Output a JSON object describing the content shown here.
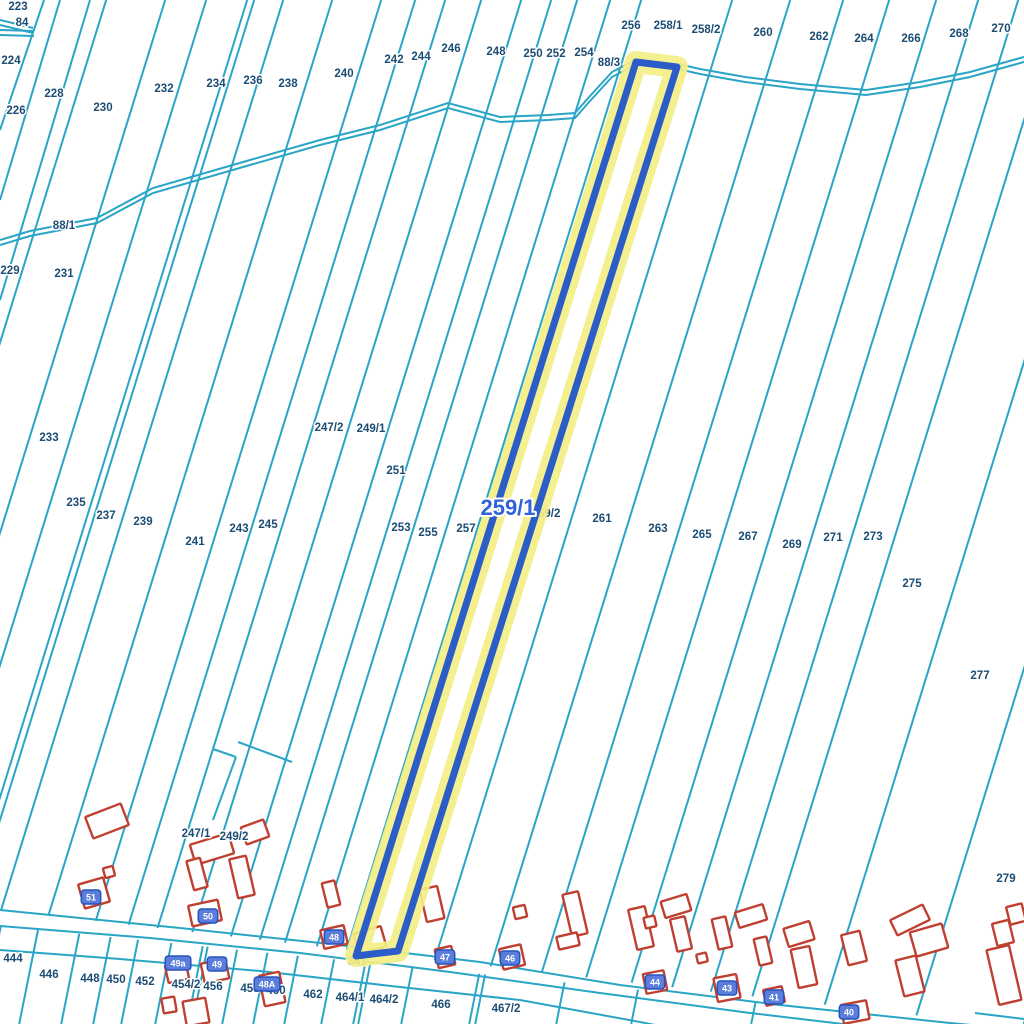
{
  "map": {
    "colors": {
      "line": "#2aa5c6",
      "stream": "#2aa5c6",
      "building": "#bf3f30",
      "label": "#1c4d74",
      "highlight_halo": "#f3ee86",
      "highlight_border": "#2b5cc8",
      "big_label_color": "#2f62d8",
      "plate_fill": "#5b7ddb",
      "plate_border": "#2753bd"
    },
    "highlight_parcel": {
      "label": "259/1",
      "points": [
        [
          636,
          62
        ],
        [
          677,
          67
        ],
        [
          398,
          951
        ],
        [
          356,
          956
        ]
      ]
    },
    "big_label": {
      "text": "259/1",
      "x": 508,
      "y": 507
    },
    "strip_lines": {
      "slope": 0.31,
      "y_ref": 520,
      "xm": [
        -55,
        4,
        45,
        86,
        93,
        122,
        171,
        220,
        254,
        284,
        320,
        360,
        390,
        416,
        449,
        480,
        571,
        629,
        682,
        728,
        775,
        817,
        857,
        900,
        975,
        1070,
        1180,
        1290
      ]
    },
    "lower_lot_lines": {
      "slope": 0.2,
      "y_ref": 980,
      "xb": [
        -10,
        28,
        70,
        102,
        130,
        164,
        196,
        201,
        231,
        262,
        293,
        330,
        362,
        367,
        410,
        478,
        484,
        565,
        640,
        760
      ]
    },
    "road_lines": [
      [
        [
          0,
          910
        ],
        [
          180,
          928
        ],
        [
          330,
          944
        ],
        [
          480,
          962
        ],
        [
          620,
          985
        ],
        [
          780,
          1005
        ],
        [
          950,
          1023
        ],
        [
          1024,
          1030
        ]
      ],
      [
        [
          0,
          926
        ],
        [
          150,
          938
        ],
        [
          300,
          953
        ],
        [
          450,
          972
        ],
        [
          600,
          993
        ],
        [
          750,
          1013
        ],
        [
          860,
          1026
        ]
      ],
      [
        [
          0,
          950
        ],
        [
          120,
          959
        ],
        [
          260,
          971
        ],
        [
          400,
          987
        ],
        [
          520,
          1000
        ],
        [
          640,
          1022
        ],
        [
          660,
          1026
        ]
      ]
    ],
    "extra_segments": [
      [
        [
          44,
          0
        ],
        [
          0,
          130
        ]
      ],
      [
        [
          60,
          0
        ],
        [
          0,
          200
        ]
      ],
      [
        [
          90,
          0
        ],
        [
          0,
          300
        ]
      ],
      [
        [
          213,
          749
        ],
        [
          236,
          757
        ]
      ],
      [
        [
          238,
          742
        ],
        [
          292,
          762
        ]
      ],
      [
        [
          236,
          757
        ],
        [
          213,
          820
        ]
      ],
      [
        [
          975,
          1013
        ],
        [
          1024,
          1019
        ]
      ]
    ],
    "stream_paths": [
      [
        [
          0,
          240
        ],
        [
          30,
          231
        ],
        [
          97,
          218
        ],
        [
          153,
          188
        ],
        [
          250,
          160
        ],
        [
          320,
          140
        ],
        [
          380,
          125
        ],
        [
          448,
          103
        ],
        [
          500,
          117
        ],
        [
          548,
          115
        ],
        [
          575,
          113
        ],
        [
          590,
          96
        ],
        [
          612,
          72
        ],
        [
          633,
          61
        ]
      ],
      [
        [
          678,
          64
        ],
        [
          700,
          69
        ],
        [
          745,
          77
        ],
        [
          800,
          84
        ],
        [
          866,
          90
        ],
        [
          920,
          82
        ],
        [
          970,
          72
        ],
        [
          1024,
          57
        ]
      ],
      [
        [
          0,
          20
        ],
        [
          33,
          28
        ]
      ],
      [
        [
          0,
          30
        ],
        [
          34,
          31
        ]
      ]
    ],
    "stream_gap": 5,
    "parcel_labels": [
      {
        "text": "223",
        "x": 18,
        "y": 6
      },
      {
        "text": "84",
        "x": 22,
        "y": 22
      },
      {
        "text": "224",
        "x": 11,
        "y": 60
      },
      {
        "text": "226",
        "x": 16,
        "y": 110
      },
      {
        "text": "228",
        "x": 54,
        "y": 93
      },
      {
        "text": "230",
        "x": 103,
        "y": 107
      },
      {
        "text": "232",
        "x": 164,
        "y": 88
      },
      {
        "text": "234",
        "x": 216,
        "y": 83
      },
      {
        "text": "236",
        "x": 253,
        "y": 80
      },
      {
        "text": "238",
        "x": 288,
        "y": 83
      },
      {
        "text": "240",
        "x": 344,
        "y": 73
      },
      {
        "text": "242",
        "x": 394,
        "y": 59
      },
      {
        "text": "244",
        "x": 421,
        "y": 56
      },
      {
        "text": "246",
        "x": 451,
        "y": 48
      },
      {
        "text": "248",
        "x": 496,
        "y": 51
      },
      {
        "text": "250",
        "x": 533,
        "y": 53
      },
      {
        "text": "252",
        "x": 556,
        "y": 53
      },
      {
        "text": "254",
        "x": 584,
        "y": 52
      },
      {
        "text": "256",
        "x": 631,
        "y": 25
      },
      {
        "text": "258/1",
        "x": 668,
        "y": 25
      },
      {
        "text": "88/3",
        "x": 609,
        "y": 62
      },
      {
        "text": "258/2",
        "x": 706,
        "y": 29
      },
      {
        "text": "260",
        "x": 763,
        "y": 32
      },
      {
        "text": "262",
        "x": 819,
        "y": 36
      },
      {
        "text": "264",
        "x": 864,
        "y": 38
      },
      {
        "text": "266",
        "x": 911,
        "y": 38
      },
      {
        "text": "268",
        "x": 959,
        "y": 33
      },
      {
        "text": "270",
        "x": 1001,
        "y": 28
      },
      {
        "text": "88/1",
        "x": 64,
        "y": 225
      },
      {
        "text": "229",
        "x": 10,
        "y": 270
      },
      {
        "text": "231",
        "x": 64,
        "y": 273
      },
      {
        "text": "233",
        "x": 49,
        "y": 437
      },
      {
        "text": "235",
        "x": 76,
        "y": 502
      },
      {
        "text": "237",
        "x": 106,
        "y": 515
      },
      {
        "text": "239",
        "x": 143,
        "y": 521
      },
      {
        "text": "241",
        "x": 195,
        "y": 541
      },
      {
        "text": "243",
        "x": 239,
        "y": 528
      },
      {
        "text": "245",
        "x": 268,
        "y": 524
      },
      {
        "text": "247/2",
        "x": 329,
        "y": 427
      },
      {
        "text": "249/1",
        "x": 371,
        "y": 428
      },
      {
        "text": "251",
        "x": 396,
        "y": 470
      },
      {
        "text": "253",
        "x": 401,
        "y": 527
      },
      {
        "text": "255",
        "x": 428,
        "y": 532
      },
      {
        "text": "257",
        "x": 466,
        "y": 528
      },
      {
        "text": "259/2",
        "x": 546,
        "y": 513
      },
      {
        "text": "261",
        "x": 602,
        "y": 518
      },
      {
        "text": "263",
        "x": 658,
        "y": 528
      },
      {
        "text": "265",
        "x": 702,
        "y": 534
      },
      {
        "text": "267",
        "x": 748,
        "y": 536
      },
      {
        "text": "269",
        "x": 792,
        "y": 544
      },
      {
        "text": "271",
        "x": 833,
        "y": 537
      },
      {
        "text": "273",
        "x": 873,
        "y": 536
      },
      {
        "text": "275",
        "x": 912,
        "y": 583
      },
      {
        "text": "277",
        "x": 980,
        "y": 675
      },
      {
        "text": "279",
        "x": 1006,
        "y": 878
      },
      {
        "text": "247/1",
        "x": 196,
        "y": 833
      },
      {
        "text": "249/2",
        "x": 234,
        "y": 836
      },
      {
        "text": "444",
        "x": 13,
        "y": 958
      },
      {
        "text": "446",
        "x": 49,
        "y": 974
      },
      {
        "text": "448",
        "x": 90,
        "y": 978
      },
      {
        "text": "450",
        "x": 116,
        "y": 979
      },
      {
        "text": "452",
        "x": 145,
        "y": 981
      },
      {
        "text": "454/2",
        "x": 186,
        "y": 984
      },
      {
        "text": "456",
        "x": 213,
        "y": 986
      },
      {
        "text": "458",
        "x": 250,
        "y": 988
      },
      {
        "text": "460",
        "x": 276,
        "y": 990
      },
      {
        "text": "462",
        "x": 313,
        "y": 994
      },
      {
        "text": "464/1",
        "x": 350,
        "y": 997
      },
      {
        "text": "464/2",
        "x": 384,
        "y": 999
      },
      {
        "text": "466",
        "x": 441,
        "y": 1004
      },
      {
        "text": "467/2",
        "x": 506,
        "y": 1008
      }
    ],
    "hidden_label": {
      "text": "341",
      "x": 357,
      "y": 961
    },
    "address_plates": [
      {
        "text": "51",
        "x": 91,
        "y": 897
      },
      {
        "text": "50",
        "x": 208,
        "y": 916
      },
      {
        "text": "49a",
        "x": 178,
        "y": 963
      },
      {
        "text": "49",
        "x": 217,
        "y": 964
      },
      {
        "text": "48A",
        "x": 267,
        "y": 984
      },
      {
        "text": "48",
        "x": 334,
        "y": 937
      },
      {
        "text": "47",
        "x": 445,
        "y": 957
      },
      {
        "text": "46",
        "x": 510,
        "y": 958
      },
      {
        "text": "44",
        "x": 655,
        "y": 982
      },
      {
        "text": "43",
        "x": 727,
        "y": 988
      },
      {
        "text": "41",
        "x": 774,
        "y": 997
      },
      {
        "text": "40",
        "x": 849,
        "y": 1012
      }
    ],
    "buildings": [
      {
        "x": 107,
        "y": 821,
        "w": 38,
        "h": 23,
        "r": -21
      },
      {
        "x": 109,
        "y": 872,
        "w": 10,
        "h": 10,
        "r": -15
      },
      {
        "x": 94,
        "y": 893,
        "w": 26,
        "h": 25,
        "r": -16
      },
      {
        "x": 212,
        "y": 849,
        "w": 40,
        "h": 21,
        "r": -17
      },
      {
        "x": 197,
        "y": 874,
        "w": 14,
        "h": 30,
        "r": -15
      },
      {
        "x": 242,
        "y": 877,
        "w": 17,
        "h": 40,
        "r": -13
      },
      {
        "x": 255,
        "y": 832,
        "w": 24,
        "h": 18,
        "r": -20
      },
      {
        "x": 205,
        "y": 913,
        "w": 30,
        "h": 21,
        "r": -12
      },
      {
        "x": 331,
        "y": 894,
        "w": 13,
        "h": 25,
        "r": -14
      },
      {
        "x": 334,
        "y": 937,
        "w": 24,
        "h": 19,
        "r": -13
      },
      {
        "x": 370,
        "y": 940,
        "w": 28,
        "h": 21,
        "r": -16
      },
      {
        "x": 432,
        "y": 904,
        "w": 18,
        "h": 33,
        "r": -13
      },
      {
        "x": 445,
        "y": 957,
        "w": 17,
        "h": 19,
        "r": -13
      },
      {
        "x": 520,
        "y": 912,
        "w": 12,
        "h": 12,
        "r": -13
      },
      {
        "x": 512,
        "y": 957,
        "w": 22,
        "h": 21,
        "r": -13
      },
      {
        "x": 575,
        "y": 914,
        "w": 16,
        "h": 43,
        "r": -13
      },
      {
        "x": 568,
        "y": 941,
        "w": 21,
        "h": 13,
        "r": -13
      },
      {
        "x": 641,
        "y": 928,
        "w": 17,
        "h": 41,
        "r": -13
      },
      {
        "x": 650,
        "y": 922,
        "w": 11,
        "h": 11,
        "r": -13
      },
      {
        "x": 676,
        "y": 906,
        "w": 27,
        "h": 17,
        "r": -17
      },
      {
        "x": 681,
        "y": 934,
        "w": 15,
        "h": 33,
        "r": -13
      },
      {
        "x": 722,
        "y": 933,
        "w": 14,
        "h": 31,
        "r": -13
      },
      {
        "x": 702,
        "y": 958,
        "w": 10,
        "h": 9,
        "r": -13
      },
      {
        "x": 751,
        "y": 916,
        "w": 29,
        "h": 16,
        "r": -17
      },
      {
        "x": 763,
        "y": 951,
        "w": 13,
        "h": 27,
        "r": -13
      },
      {
        "x": 655,
        "y": 982,
        "w": 21,
        "h": 20,
        "r": -11
      },
      {
        "x": 727,
        "y": 988,
        "w": 23,
        "h": 24,
        "r": -11
      },
      {
        "x": 799,
        "y": 934,
        "w": 27,
        "h": 19,
        "r": -17
      },
      {
        "x": 804,
        "y": 967,
        "w": 19,
        "h": 39,
        "r": -12
      },
      {
        "x": 774,
        "y": 996,
        "w": 19,
        "h": 16,
        "r": -12
      },
      {
        "x": 854,
        "y": 948,
        "w": 19,
        "h": 31,
        "r": -14
      },
      {
        "x": 855,
        "y": 1012,
        "w": 26,
        "h": 19,
        "r": -11
      },
      {
        "x": 910,
        "y": 920,
        "w": 36,
        "h": 17,
        "r": -26
      },
      {
        "x": 929,
        "y": 940,
        "w": 33,
        "h": 25,
        "r": -16
      },
      {
        "x": 910,
        "y": 976,
        "w": 21,
        "h": 37,
        "r": -14
      },
      {
        "x": 1003,
        "y": 933,
        "w": 17,
        "h": 23,
        "r": -14
      },
      {
        "x": 1004,
        "y": 975,
        "w": 23,
        "h": 56,
        "r": -13
      },
      {
        "x": 1016,
        "y": 914,
        "w": 16,
        "h": 18,
        "r": -14
      },
      {
        "x": 177,
        "y": 972,
        "w": 21,
        "h": 18,
        "r": -12
      },
      {
        "x": 215,
        "y": 971,
        "w": 25,
        "h": 20,
        "r": -12
      },
      {
        "x": 272,
        "y": 989,
        "w": 21,
        "h": 31,
        "r": -12
      },
      {
        "x": 169,
        "y": 1005,
        "w": 13,
        "h": 15,
        "r": -10
      },
      {
        "x": 196,
        "y": 1012,
        "w": 23,
        "h": 25,
        "r": -10
      }
    ]
  }
}
